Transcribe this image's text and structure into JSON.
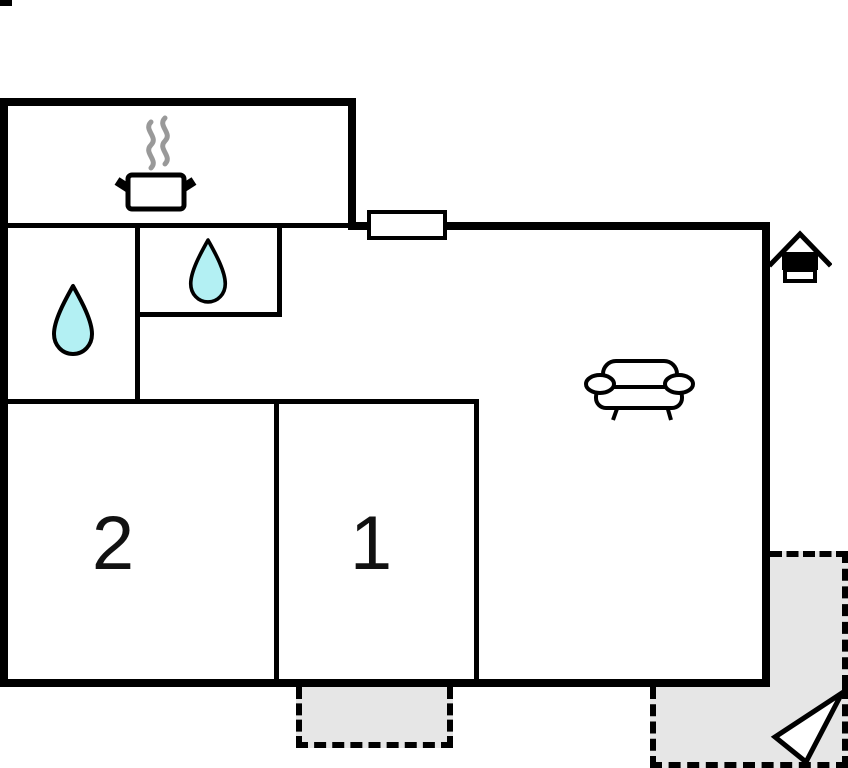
{
  "plan": {
    "type": "floor-plan",
    "rooms": {
      "room1": {
        "label": "1"
      },
      "room2": {
        "label": "2"
      }
    },
    "icons": {
      "stove": "stove-pot-icon",
      "water_drop": "water-drop-icon",
      "sofa": "sofa-icon",
      "entrance": "entrance-house-icon",
      "arrow": "direction-arrow-icon"
    },
    "colors": {
      "wall": "#000000",
      "terrace_fill": "#e6e6e6",
      "water": "#b3f0f3",
      "steam": "#999999",
      "paper": "#ffffff"
    }
  }
}
